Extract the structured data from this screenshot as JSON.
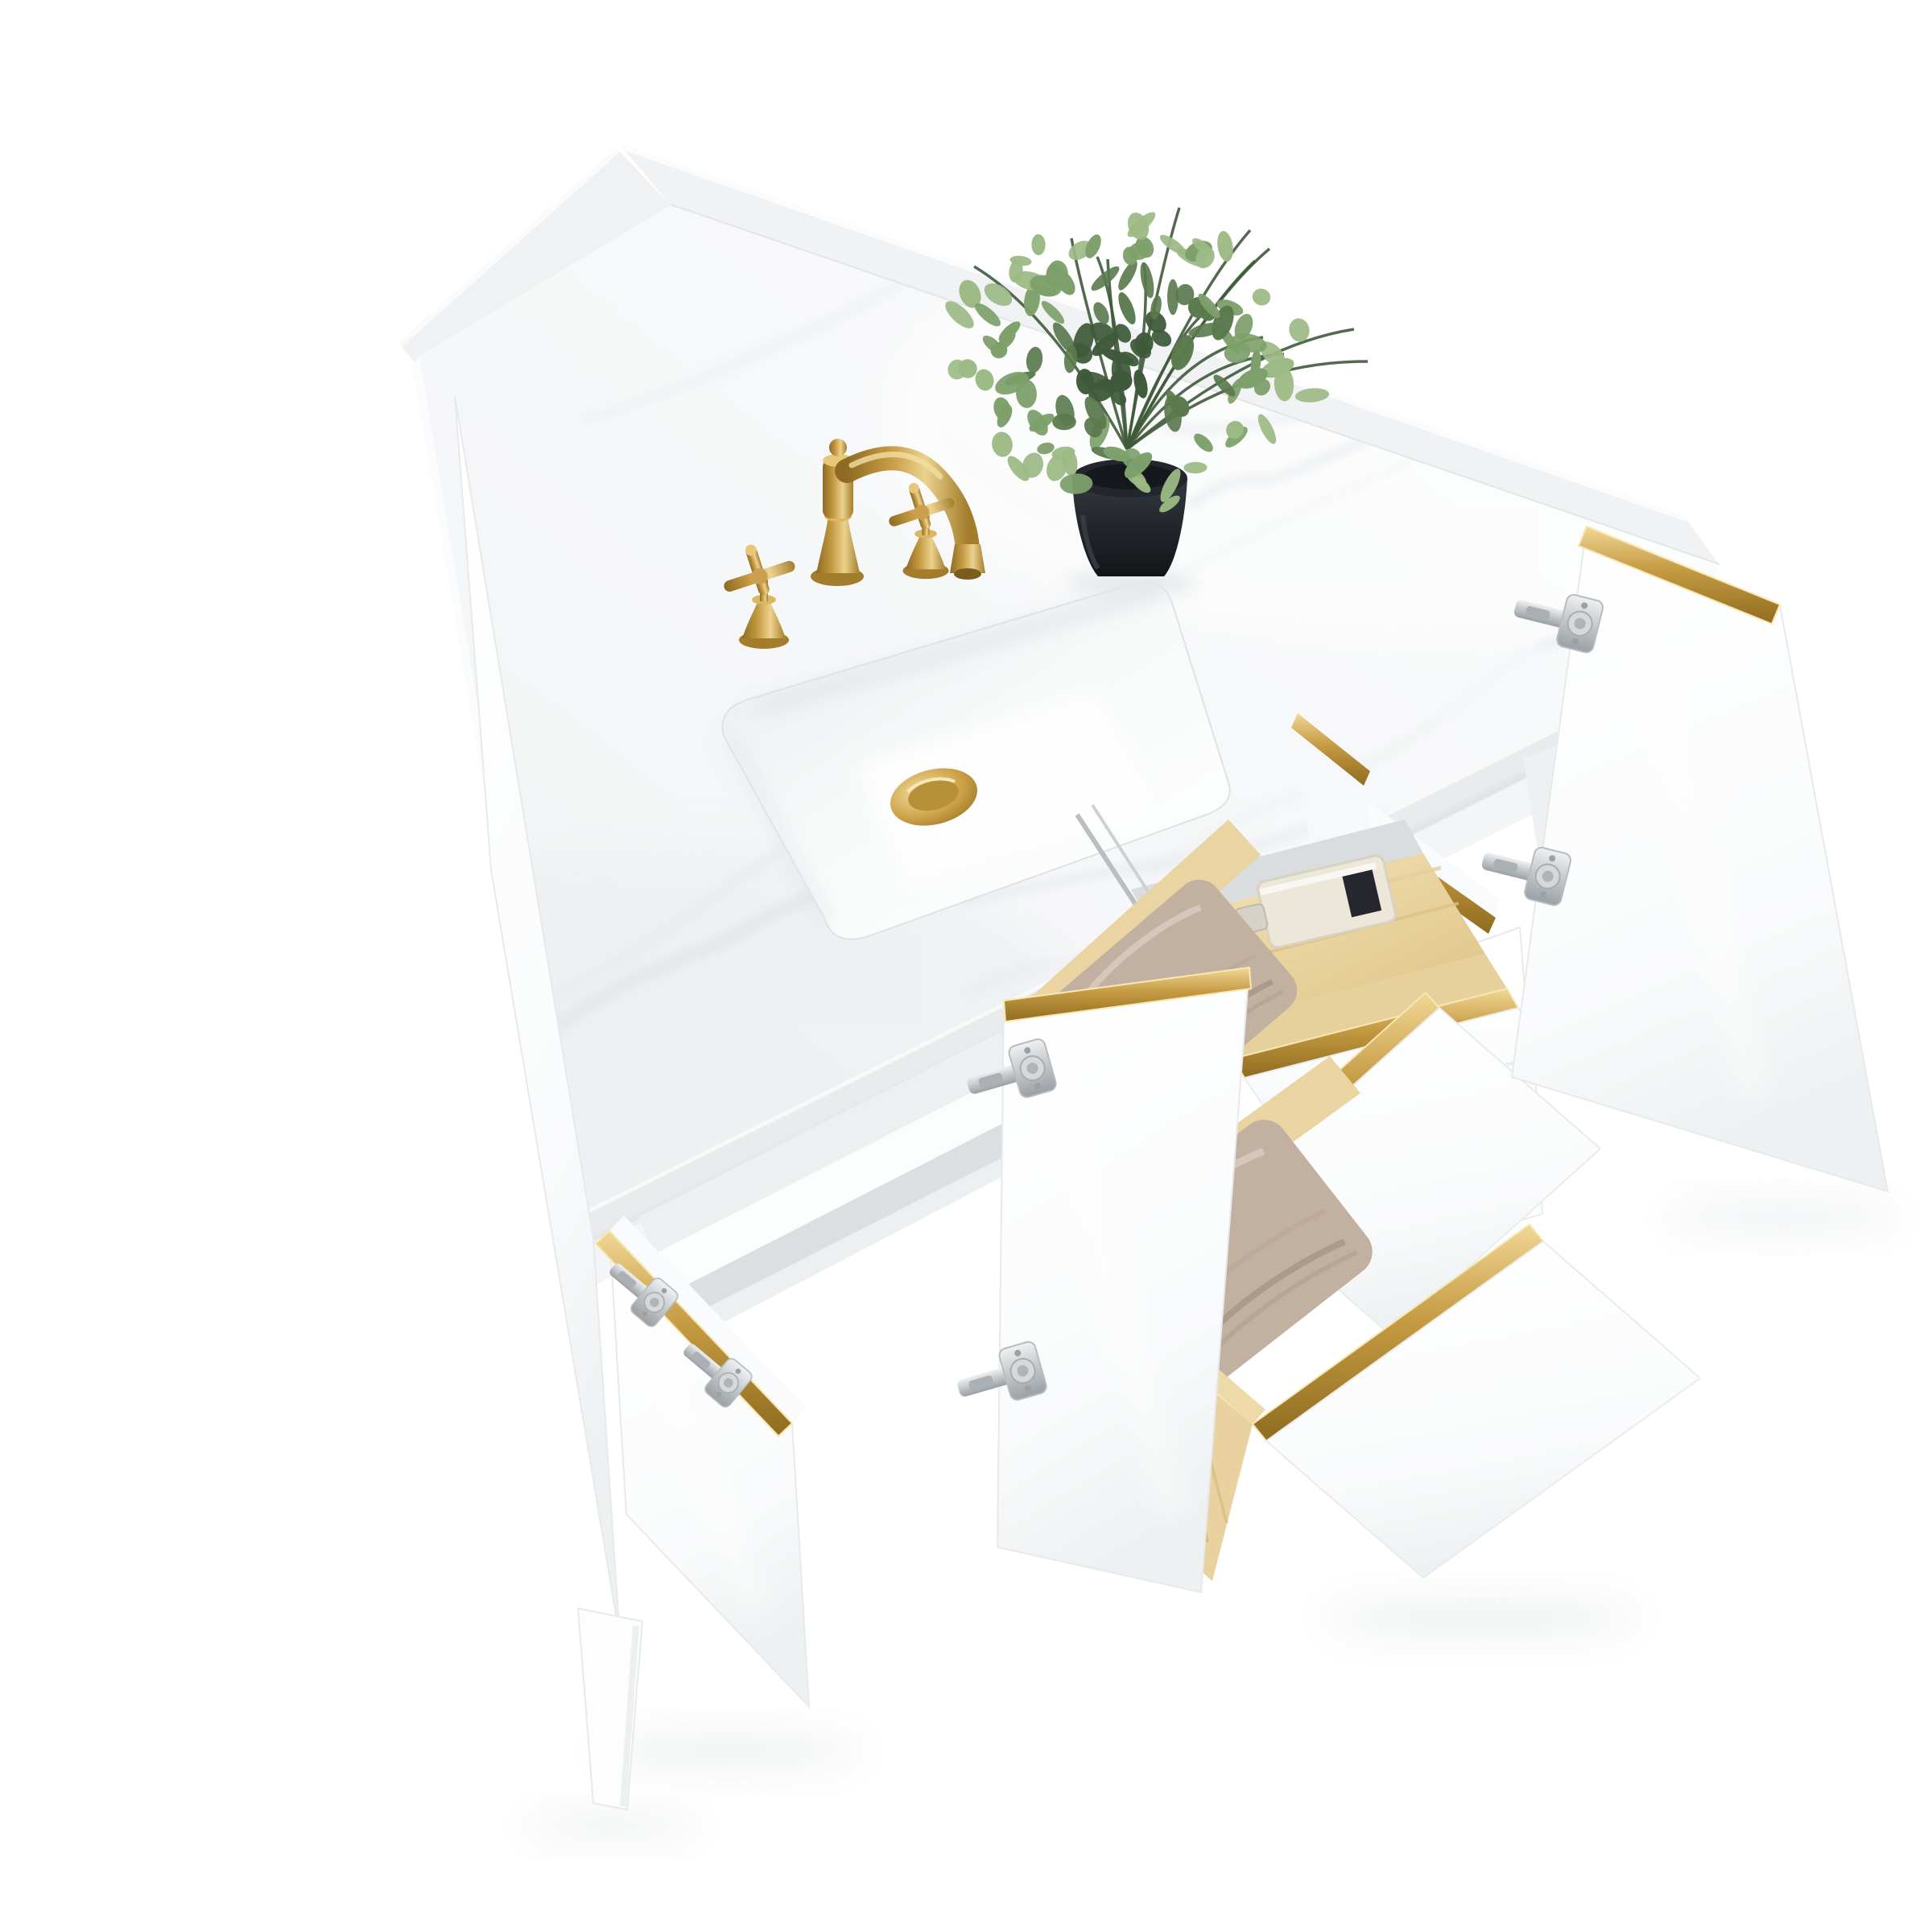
{
  "scene": {
    "type": "product-photo",
    "subject": "freestanding single-sink bathroom vanity viewed from above at a three-quarter angle",
    "background": "#ffffff"
  },
  "countertop": {
    "material": "white engineered stone with faint gray veining",
    "backsplash": true,
    "side_splash": true
  },
  "sink": {
    "style": "undermount",
    "shape": "rectangular",
    "color": "#ffffff"
  },
  "drain": {
    "type": "pop-up",
    "finish": "brushed gold"
  },
  "faucet": {
    "mount": "widespread 3-hole",
    "finish": "brushed gold",
    "spout": "traditional curved spout",
    "handles": "two cross handles"
  },
  "plant": {
    "kind": "faux eucalyptus",
    "pot": "black tapered planter"
  },
  "cabinet": {
    "finish": "white",
    "hardware": "gold edge-channel pulls",
    "hinges": "nickel concealed hinges",
    "legs": "tapered white",
    "doors_open": 3,
    "drawers_open": 2,
    "tilt_tray_open": true,
    "drawer_boxes": "natural pine"
  },
  "tray_contents": [
    "clear glass perfume bottle with dark label",
    "navy cylindrical cosmetic bottle with silver band"
  ],
  "drawer_contents": [
    "folded taupe towel",
    "folded taupe towel"
  ],
  "foliage": {
    "leaf_count": 124,
    "stem_count": 14
  },
  "veining": {
    "vein_count": 16
  },
  "palette": {
    "background": "#ffffff",
    "marble_base": "#f6f7f8",
    "marble_edge": "#e9ecee",
    "marble_vein": "#e2e7ea",
    "splash": "#f0f2f4",
    "white_panel": "#ffffff",
    "panel_shade": "#eef1f2",
    "panel_line": "#e3e6e8",
    "interior": "#edf0f1",
    "interior_deep": "#dcdfe2",
    "gold": "#c59a42",
    "gold_light": "#f1d795",
    "gold_dark": "#8f6c20",
    "nickel": "#c3c7ca",
    "nickel_light": "#eff1f2",
    "nickel_dark": "#9aa0a4",
    "pine": "#f5e6bc",
    "pine_dark": "#ddc183",
    "pine_grain": "#cfae6e",
    "towel": "#c2b0a1",
    "towel_shade": "#a8968a",
    "towel_light": "#d7cabe",
    "pot_dark": "#121518",
    "pot_mid": "#22262b",
    "pot_light": "#343a40",
    "leaf_dark": "#3f5a3a",
    "leaf_mid": "#5a7a4e",
    "leaf_light": "#7da06b",
    "leaf_pale": "#9cba85",
    "glass": "#ece7d9",
    "glass_label": "#26262e",
    "glass_cap": "#d5d2c8",
    "bottle_navy": "#262d41",
    "bottle_band": "#c9ced4",
    "shadow": "#e8eaec",
    "brass_dark": "#8e6a22",
    "brass_mid": "#c59a42",
    "brass_light": "#ecd28e"
  }
}
